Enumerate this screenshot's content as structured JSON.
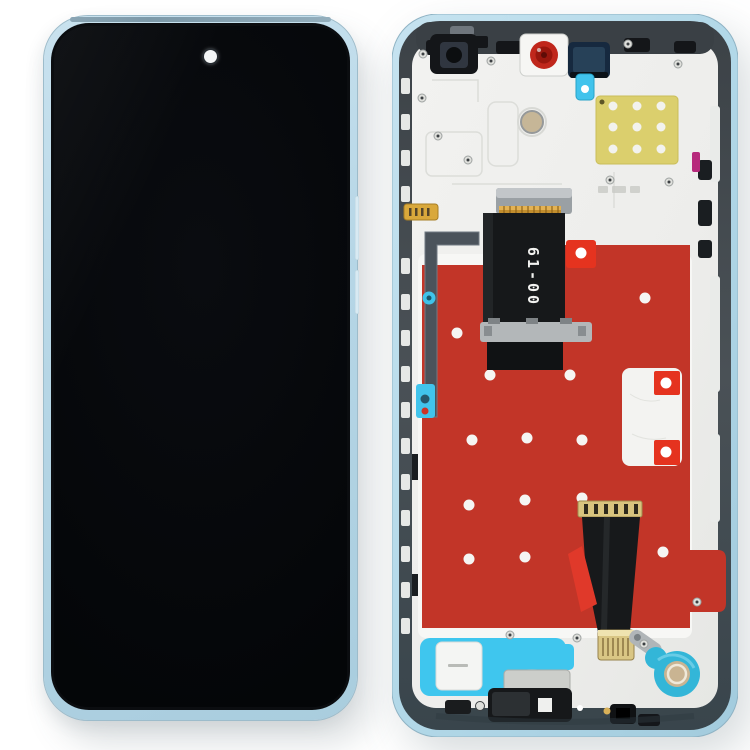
{
  "image": {
    "type": "product-photo",
    "subject": "Phone LCD screen and digitizer full assembly with frame - front view (left) and rear frame view (right)",
    "background_color": "#ffffff"
  },
  "front_assembly": {
    "label": "front-view",
    "frame_color": "#b7d6e6",
    "screen_color": "#06080a",
    "front_camera": "punch-hole-top-center"
  },
  "rear_assembly": {
    "label": "rear-frame-view",
    "edge_color": "#b4dae9",
    "chassis_color": "#40474d",
    "plate_color": "#efefed",
    "lcd_adhesive_color": "#c23528",
    "pull_tab_color": "#e5331f",
    "calibration_sticker_color": "#dbcf6d",
    "speaker_adhesive_color": "#3fc6ee",
    "camera_ring_color": "#c0271c",
    "flex_cable": {
      "label": "61-00"
    }
  }
}
